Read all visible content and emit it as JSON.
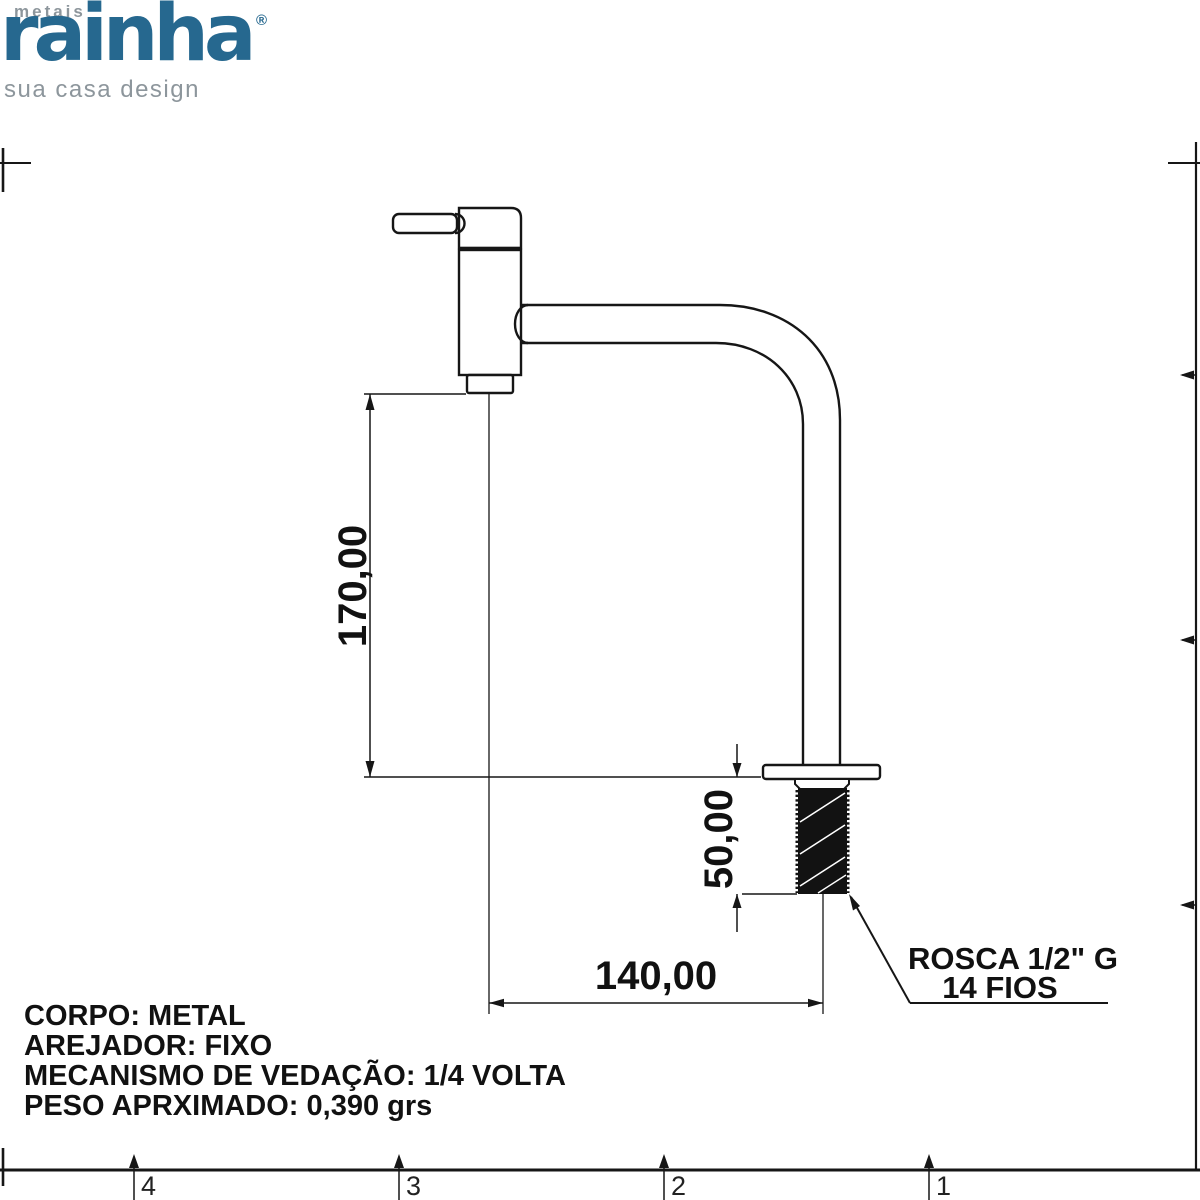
{
  "brand": {
    "word_top": "metais",
    "name": "rainha",
    "registered": "®",
    "tagline": "sua casa design",
    "accent_color": "#26688f",
    "muted_color": "#8d969c"
  },
  "dimensions": {
    "height": "170,00",
    "thread_length": "50,00",
    "spout_reach": "140,00"
  },
  "thread_note": {
    "line1": "ROSCA 1/2\" G",
    "line2": "14 FIOS"
  },
  "specs": {
    "body": "CORPO: METAL",
    "aerator": "AREJADOR: FIXO",
    "seal": "MECANISMO DE VEDAÇÃO: 1/4 VOLTA",
    "weight": "PESO APRXIMADO: 0,390 grs"
  },
  "frame_markers": {
    "m4": "4",
    "m3": "3",
    "m2": "2",
    "m1": "1"
  },
  "line_color": "#161616"
}
